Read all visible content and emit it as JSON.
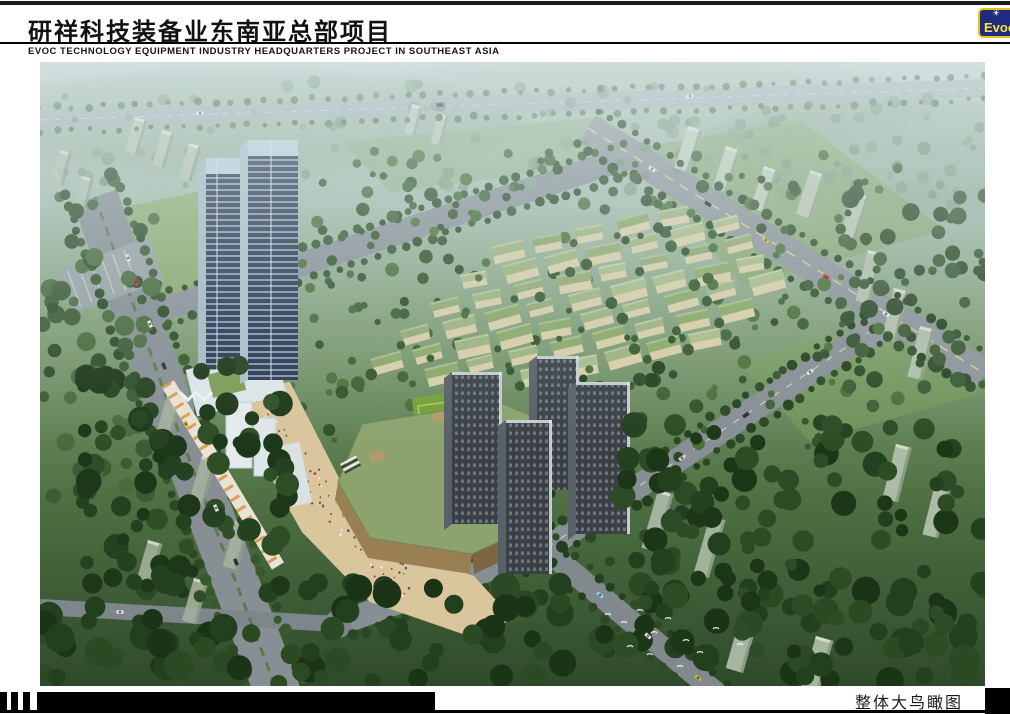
{
  "header": {
    "title_cn": "研祥科技装备业东南亚总部项目",
    "subtitle_en": "EVOC TECHNOLOGY EQUIPMENT INDUSTRY HEADQUARTERS PROJECT IN SOUTHEAST ASIA",
    "logo": {
      "text": "Evoc",
      "icon": "sunburst-icon",
      "colors": {
        "bg": "#1d2c80",
        "border": "#e9c117",
        "text": "#ffe23a"
      }
    }
  },
  "footer": {
    "caption": "整体大鸟瞰图"
  },
  "scene": {
    "description": "aerial-bird-eye-rendering-of-evoc-headquarters-masterplan",
    "palette": {
      "haze_top": "#b9cdc9",
      "far_green": "#7d9b72",
      "dark_green": "#2f4a2b",
      "road_gray": "#878f94",
      "field_green": "#74a038",
      "podium_roof": "#8ca36e",
      "plaza_sand": "#d9c69c",
      "villa_roof": "#9db37d",
      "villa_wall": "#d8cfa9",
      "office_tower": "#2b3750",
      "res_tower": "#3a4045",
      "slab_pale": "#b7c2b3"
    },
    "villa_grid": {
      "origin": [
        270,
        353
      ],
      "col_step": [
        42,
        -9
      ],
      "row_step": [
        30,
        -28
      ],
      "cols": 10,
      "rows": 7,
      "roofs": [
        "#9db37d",
        "#93a972",
        "#a8bc88",
        "#8ba768"
      ],
      "wall": "#d8cfa9"
    },
    "tree_regions": [
      {
        "layer": "far",
        "x": 0,
        "y": 18,
        "w": 945,
        "h": 112,
        "count": 85,
        "rmin": 3,
        "rmax": 7,
        "colors": [
          "#7d9a7f",
          "#6f8f71",
          "#88a489"
        ],
        "op": 0.8
      },
      {
        "layer": "far",
        "x": 600,
        "y": 55,
        "w": 340,
        "h": 90,
        "count": 40,
        "rmin": 3,
        "rmax": 6,
        "colors": [
          "#83a083",
          "#74947a"
        ],
        "op": 0.8
      },
      {
        "layer": "under",
        "x": 0,
        "y": 110,
        "w": 115,
        "h": 330,
        "count": 60,
        "rmin": 5,
        "rmax": 10,
        "colors": [
          "#3b5c35",
          "#2f4c2b",
          "#486c3c"
        ],
        "op": 1
      },
      {
        "layer": "under",
        "x": 250,
        "y": 85,
        "w": 610,
        "h": 300,
        "count": 150,
        "rmin": 3,
        "rmax": 7,
        "colors": [
          "#3d6033",
          "#325229",
          "#4a7038"
        ],
        "op": 1
      },
      {
        "layer": "under",
        "x": 800,
        "y": 130,
        "w": 145,
        "h": 225,
        "count": 48,
        "rmin": 4,
        "rmax": 9,
        "colors": [
          "#3a5a33",
          "#2e4a29"
        ],
        "op": 1
      },
      {
        "layer": "over",
        "x": 260,
        "y": 100,
        "w": 580,
        "h": 280,
        "count": 70,
        "rmin": 3,
        "rmax": 6,
        "colors": [
          "#37592f",
          "#2c4a26",
          "#446a36"
        ],
        "op": 1
      },
      {
        "layer": "over",
        "x": 400,
        "y": 300,
        "w": 250,
        "h": 210,
        "count": 45,
        "rmin": 4,
        "rmax": 8,
        "colors": [
          "#2c4a26",
          "#233e1f"
        ],
        "op": 1
      },
      {
        "layer": "near",
        "x": 0,
        "y": 520,
        "w": 945,
        "h": 104,
        "count": 115,
        "rmin": 7,
        "rmax": 15,
        "colors": [
          "#22401e",
          "#1b3418",
          "#2b4a24"
        ],
        "op": 1
      },
      {
        "layer": "near",
        "x": 40,
        "y": 300,
        "w": 210,
        "h": 240,
        "count": 85,
        "rmin": 6,
        "rmax": 13,
        "colors": [
          "#24421f",
          "#1d3719",
          "#2e4e26"
        ],
        "op": 1
      },
      {
        "layer": "near",
        "x": 580,
        "y": 360,
        "w": 365,
        "h": 235,
        "count": 105,
        "rmin": 6,
        "rmax": 13,
        "colors": [
          "#23411f",
          "#1c3618",
          "#2d4c25"
        ],
        "op": 1
      }
    ],
    "tree_lines": [
      {
        "pts": [
          [
            0,
            58
          ],
          [
            945,
            26
          ]
        ],
        "off": 12,
        "step": 16,
        "rmin": 2,
        "rmax": 4,
        "colors": [
          "#5d7f57",
          "#52744e"
        ]
      },
      {
        "pts": [
          [
            55,
            135
          ],
          [
            135,
            360
          ],
          [
            245,
            650
          ]
        ],
        "off": 28,
        "step": 13,
        "rmin": 3.5,
        "rmax": 6,
        "colors": [
          "#2c4a26",
          "#355a2c"
        ]
      },
      {
        "pts": [
          [
            108,
            252
          ],
          [
            590,
            95
          ]
        ],
        "off": 16,
        "step": 14,
        "rmin": 3,
        "rmax": 5,
        "colors": [
          "#33552c",
          "#2b4a25"
        ]
      },
      {
        "pts": [
          [
            548,
            66
          ],
          [
            945,
            312
          ]
        ],
        "off": 20,
        "step": 14,
        "rmin": 3,
        "rmax": 5.5,
        "colors": [
          "#2f5129",
          "#264223"
        ]
      },
      {
        "pts": [
          [
            832,
            268
          ],
          [
            505,
            487
          ],
          [
            298,
            562
          ]
        ],
        "off": 16,
        "step": 14,
        "rmin": 3,
        "rmax": 5.5,
        "colors": [
          "#2a4824",
          "#224020"
        ]
      },
      {
        "pts": [
          [
            505,
            487
          ],
          [
            705,
            655
          ]
        ],
        "off": 14,
        "step": 15,
        "rmin": 3,
        "rmax": 5,
        "colors": [
          "#23411f",
          "#2c4a26"
        ]
      },
      {
        "pts": [
          [
            222,
            336
          ],
          [
            320,
            470
          ],
          [
            420,
            545
          ],
          [
            468,
            568
          ]
        ],
        "off": 0,
        "step": 15,
        "rmin": 3.5,
        "rmax": 6,
        "colors": [
          "#2e5126",
          "#26451f"
        ]
      }
    ],
    "slab_groups": [
      {
        "x": 95,
        "y": 55,
        "n": 3,
        "sx": 27,
        "sy": 13,
        "w": 13,
        "h": 36,
        "rot": 16,
        "fill": "#b7c2b3",
        "op": 0.95
      },
      {
        "x": 372,
        "y": 42,
        "n": 2,
        "sx": 26,
        "sy": 10,
        "w": 11,
        "h": 30,
        "rot": 14,
        "fill": "#bcc6b8",
        "op": 0.9
      },
      {
        "x": 648,
        "y": 64,
        "n": 3,
        "sx": 38,
        "sy": 20,
        "w": 15,
        "h": 44,
        "rot": 18,
        "fill": "#c2cdbd",
        "op": 0.95
      },
      {
        "x": 770,
        "y": 108,
        "n": 2,
        "sx": 44,
        "sy": 22,
        "w": 16,
        "h": 46,
        "rot": 18,
        "fill": "#bec9b8",
        "op": 0.9
      },
      {
        "x": 828,
        "y": 188,
        "n": 3,
        "sx": 26,
        "sy": 38,
        "w": 15,
        "h": 52,
        "rot": 14,
        "fill": "#b4c2ae",
        "op": 0.95
      },
      {
        "x": 618,
        "y": 428,
        "n": 2,
        "sx": 52,
        "sy": 26,
        "w": 16,
        "h": 60,
        "rot": 16,
        "fill": "#a9b7a3",
        "op": 0.95
      },
      {
        "x": 700,
        "y": 556,
        "n": 2,
        "sx": 76,
        "sy": 18,
        "w": 18,
        "h": 52,
        "rot": 16,
        "fill": "#aebca8",
        "op": 0.95
      },
      {
        "x": 856,
        "y": 382,
        "n": 2,
        "sx": 40,
        "sy": 36,
        "w": 16,
        "h": 56,
        "rot": 14,
        "fill": "#b2c0ac",
        "op": 0.95
      },
      {
        "x": 128,
        "y": 330,
        "n": 3,
        "sx": 34,
        "sy": 64,
        "w": 15,
        "h": 48,
        "rot": 16,
        "fill": "#a8b4a2",
        "op": 0.85
      },
      {
        "x": 108,
        "y": 478,
        "n": 2,
        "sx": 46,
        "sy": 38,
        "w": 15,
        "h": 44,
        "rot": 16,
        "fill": "#a3b09d",
        "op": 0.9
      },
      {
        "x": 20,
        "y": 88,
        "n": 2,
        "sx": 22,
        "sy": 26,
        "w": 12,
        "h": 34,
        "rot": 14,
        "fill": "#b3bfb0",
        "op": 0.85
      }
    ],
    "cars": [
      {
        "x": 88,
        "y": 196,
        "rot": 70,
        "color": "#e8e8e8"
      },
      {
        "x": 96,
        "y": 220,
        "rot": 70,
        "color": "#b8302a"
      },
      {
        "x": 110,
        "y": 262,
        "rot": 69,
        "color": "#ececec"
      },
      {
        "x": 124,
        "y": 304,
        "rot": 68,
        "color": "#2c3236"
      },
      {
        "x": 146,
        "y": 362,
        "rot": 68,
        "color": "#ddc938"
      },
      {
        "x": 176,
        "y": 446,
        "rot": 67,
        "color": "#e8e8e8"
      },
      {
        "x": 196,
        "y": 500,
        "rot": 67,
        "color": "#30363a"
      },
      {
        "x": 160,
        "y": 51,
        "rot": -2,
        "color": "#dfe3e3"
      },
      {
        "x": 400,
        "y": 43,
        "rot": -2,
        "color": "#33383c"
      },
      {
        "x": 650,
        "y": 34,
        "rot": -2,
        "color": "#e8e8e8"
      },
      {
        "x": 612,
        "y": 107,
        "rot": 32,
        "color": "#eeeeee"
      },
      {
        "x": 668,
        "y": 142,
        "rot": 32,
        "color": "#23282c"
      },
      {
        "x": 726,
        "y": 178,
        "rot": 32,
        "color": "#e8c52f"
      },
      {
        "x": 786,
        "y": 215,
        "rot": 32,
        "color": "#c23228"
      },
      {
        "x": 846,
        "y": 252,
        "rot": 32,
        "color": "#ececec"
      },
      {
        "x": 770,
        "y": 310,
        "rot": 146,
        "color": "#e9e9e9"
      },
      {
        "x": 706,
        "y": 353,
        "rot": 146,
        "color": "#2c3136"
      },
      {
        "x": 642,
        "y": 396,
        "rot": 146,
        "color": "#d8d8d8"
      },
      {
        "x": 560,
        "y": 533,
        "rot": 40,
        "color": "#8fd4e8"
      },
      {
        "x": 608,
        "y": 574,
        "rot": 40,
        "color": "#e4e4e4"
      },
      {
        "x": 658,
        "y": 616,
        "rot": 40,
        "color": "#d2b62c"
      },
      {
        "x": 80,
        "y": 550,
        "rot": 3,
        "color": "#e2e2e2"
      }
    ],
    "birds": [
      {
        "x": 568,
        "y": 552
      },
      {
        "x": 584,
        "y": 560
      },
      {
        "x": 600,
        "y": 548
      },
      {
        "x": 614,
        "y": 570
      },
      {
        "x": 628,
        "y": 556
      },
      {
        "x": 590,
        "y": 584
      },
      {
        "x": 610,
        "y": 592
      },
      {
        "x": 646,
        "y": 578
      },
      {
        "x": 660,
        "y": 590
      },
      {
        "x": 676,
        "y": 566
      },
      {
        "x": 700,
        "y": 582
      },
      {
        "x": 640,
        "y": 604
      }
    ],
    "people": {
      "x": 214,
      "y": 330,
      "rot": 49,
      "w": 255,
      "h": 30,
      "count": 95,
      "colors": [
        "#6b4f33",
        "#f0e8d8",
        "#c3352b",
        "#3a5a8c",
        "#8a6a45"
      ]
    }
  }
}
